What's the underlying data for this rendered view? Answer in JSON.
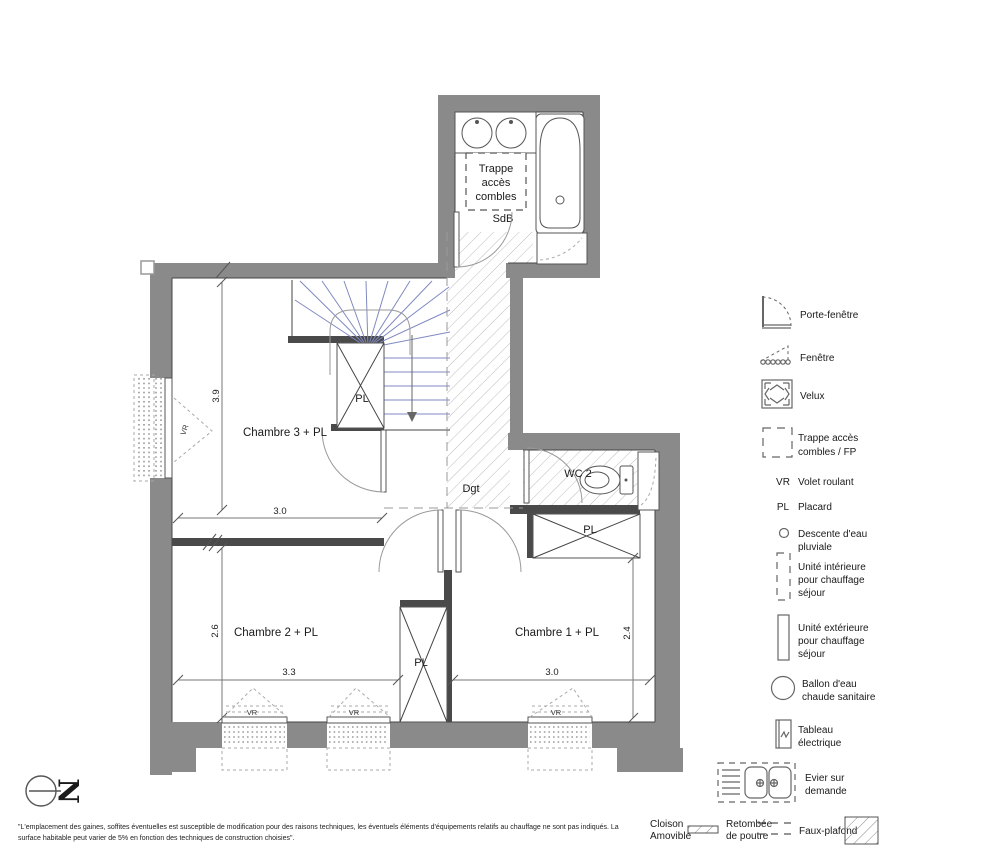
{
  "plan": {
    "labels": {
      "sdb": "SdB",
      "dgt": "Dgt",
      "wc": "WC 2",
      "ch3": "Chambre 3 + PL",
      "ch2": "Chambre 2 + PL",
      "ch1": "Chambre 1 + PL",
      "trappe_line1": "Trappe",
      "trappe_line2": "accès",
      "trappe_line3": "combles",
      "pl": "PL",
      "vr": "VR",
      "north": "N"
    },
    "dims": {
      "ch3_h": "3.9",
      "ch3_w": "3.0",
      "ch2_h": "2.6",
      "ch2_w": "3.3",
      "ch1_h": "2.4",
      "ch1_w": "3.0"
    }
  },
  "legend": {
    "items": [
      {
        "icon": "porte-fenetre-icon",
        "lines": [
          "Porte-fenêtre"
        ]
      },
      {
        "icon": "fenetre-icon",
        "lines": [
          "Fenêtre"
        ]
      },
      {
        "icon": "velux-icon",
        "lines": [
          "Velux"
        ]
      },
      {
        "icon": "trappe-acces-icon",
        "lines": [
          "Trappe accès",
          "combles / FP"
        ]
      },
      {
        "abbr": "VR",
        "lines": [
          "Volet roulant"
        ]
      },
      {
        "abbr": "PL",
        "lines": [
          "Placard"
        ]
      },
      {
        "icon": "descente-eau-icon",
        "lines": [
          "Descente d'eau",
          "pluviale"
        ]
      },
      {
        "icon": "unite-interieure-icon",
        "lines": [
          "Unité intérieure",
          "pour chauffage",
          "séjour"
        ]
      },
      {
        "icon": "unite-exterieure-icon",
        "lines": [
          "Unité extérieure",
          "pour chauffage",
          "séjour"
        ]
      },
      {
        "icon": "ballon-eau-icon",
        "lines": [
          "Ballon d'eau",
          "chaude sanitaire"
        ]
      },
      {
        "icon": "tableau-electrique-icon",
        "lines": [
          "Tableau",
          "électrique"
        ]
      },
      {
        "icon": "evier-icon",
        "lines": [
          "Evier sur",
          "demande"
        ]
      }
    ],
    "bottom": {
      "cloison_line1": "Cloison",
      "cloison_line2": "Amovible",
      "retombee_line1": "Retombée",
      "retombee_line2": "de poutre",
      "faux_plafond": "Faux-plafond"
    }
  },
  "footer": {
    "line1": "\"L'emplacement des gaines, soffites éventuelles est susceptible de modification pour des raisons techniques, les éventuels éléments d'équipements relatifs au chauffage ne sont pas indiqués. La",
    "line2": "surface habitable peut varier de 5% en fonction des techniques de construction choisies\"."
  },
  "colors": {
    "wall": "#8a8a8a",
    "dark_wall": "#4a4a4a",
    "stair_tread": "#8089c0",
    "hatch": "#bcbcbc",
    "background": "#ffffff",
    "text": "#1a1a1a"
  }
}
